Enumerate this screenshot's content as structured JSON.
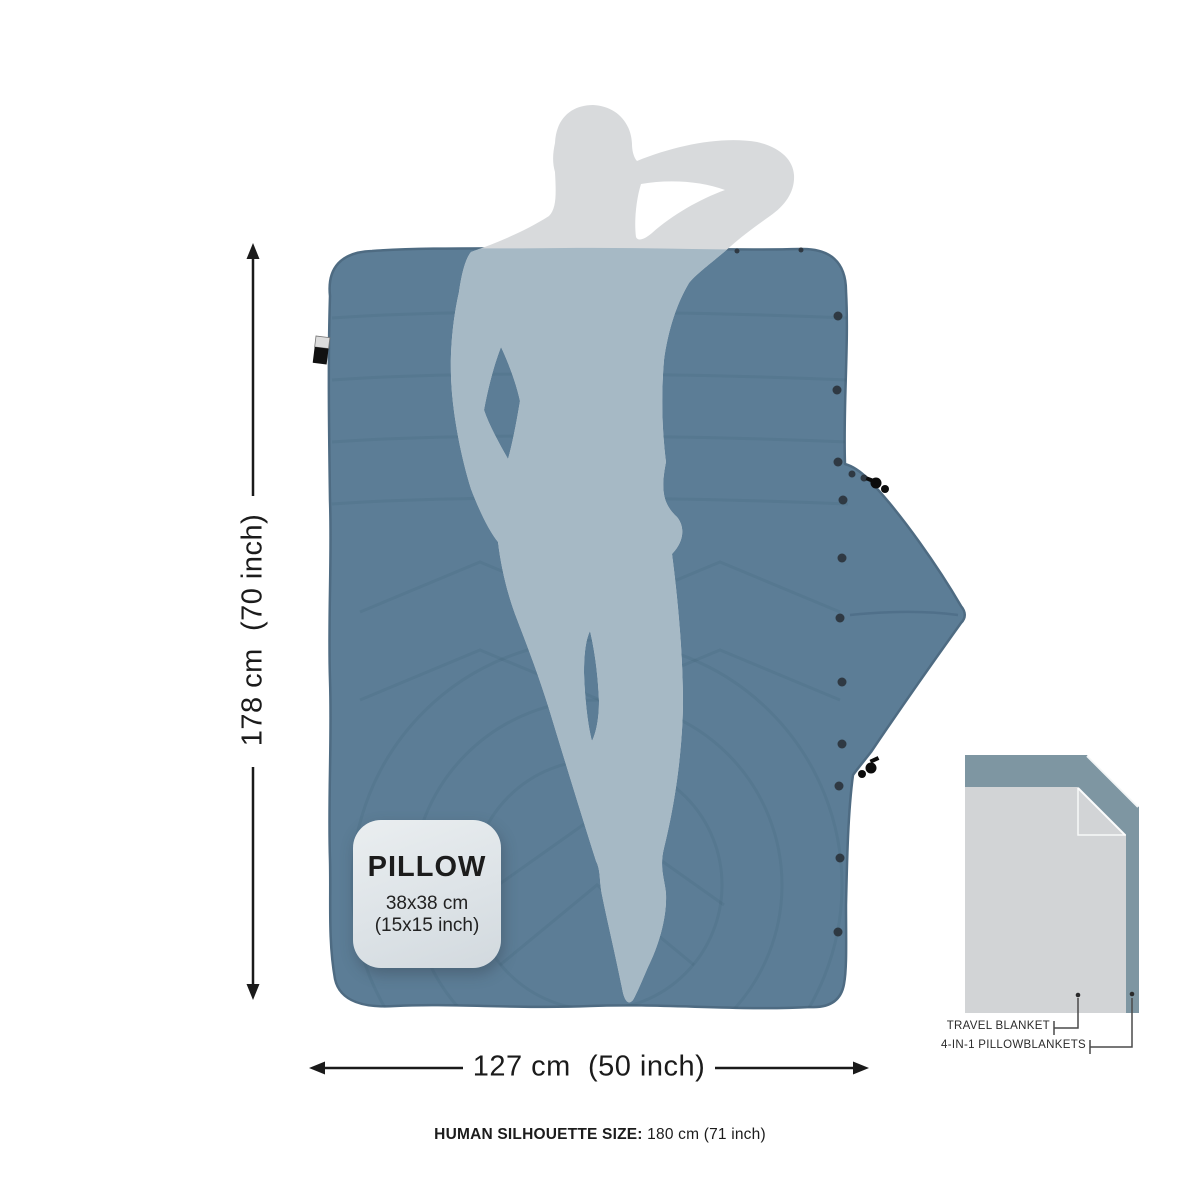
{
  "dimensions": {
    "height_label": "178 cm  (70 inch)",
    "width_label": "127 cm  (50 inch)"
  },
  "pillow_card": {
    "title": "PILLOW",
    "size_cm": "38x38 cm",
    "size_inch": "(15x15 inch)"
  },
  "caption": {
    "bold": "HUMAN SILHOUETTE SIZE:",
    "regular": "180 cm (71 inch)"
  },
  "inset": {
    "labels": [
      {
        "text": "TRAVEL BLANKET"
      },
      {
        "text": "4-IN-1 PILLOWBLANKETS"
      }
    ]
  },
  "colors": {
    "blanket": "#5C7D96",
    "blanket_edge": "#4E6B82",
    "silhouette": "#D8DADC",
    "silhouette_overlap": "#A6B9C5",
    "inset_back": "#7E96A2",
    "inset_front": "#D2D4D6",
    "arrow": "#1A1A1A"
  }
}
